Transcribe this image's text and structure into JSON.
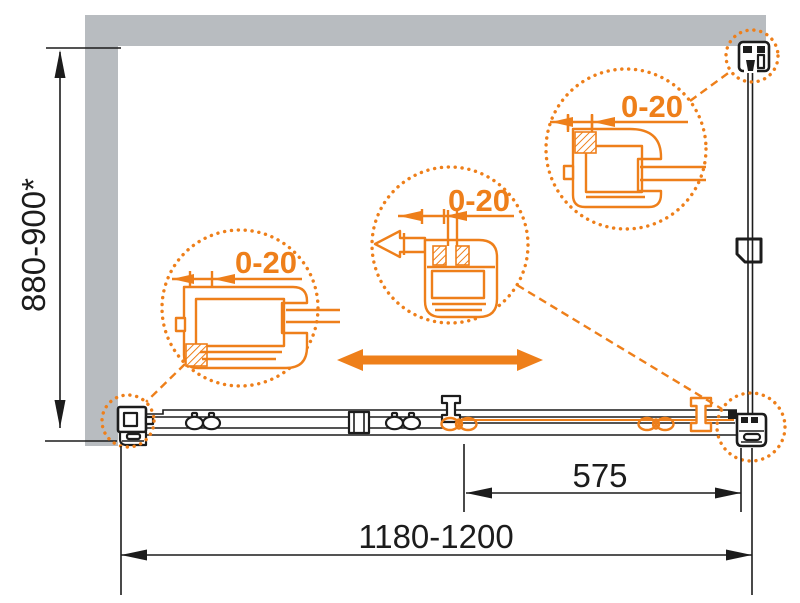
{
  "labels": {
    "height": "880-900*",
    "width": "1180-1200",
    "door_travel": "575",
    "detail_left_adjustment": "0-20",
    "detail_middle_adjustment": "0-20",
    "detail_right_adjustment": "0-20"
  },
  "colors": {
    "accent": "#EE7F1A",
    "wall": "#B8BCC0",
    "line": "#1C1C1C",
    "background": "#FFFFFF"
  }
}
